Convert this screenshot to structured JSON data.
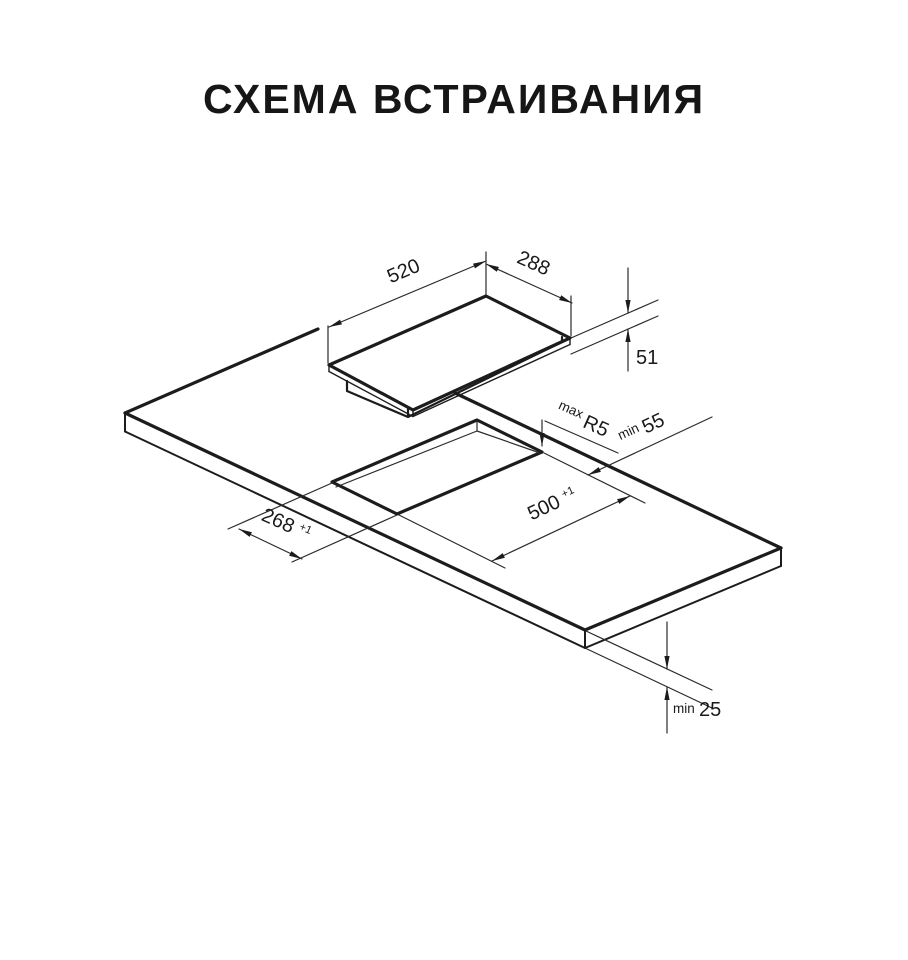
{
  "title": "СХЕМА ВСТРАИВАНИЯ",
  "colors": {
    "background": "#ffffff",
    "line": "#1c1c1c",
    "text": "#1a1a1a"
  },
  "dimensions": {
    "hob_width": {
      "value": "520"
    },
    "hob_depth": {
      "value": "288"
    },
    "hob_height": {
      "value": "51"
    },
    "cutout_corner_radius": {
      "prefix": "max",
      "value": "R5"
    },
    "cutout_back_clearance": {
      "prefix": "min",
      "value": "55"
    },
    "cutout_length": {
      "value": "500",
      "tolerance": "+1"
    },
    "cutout_width": {
      "value": "268",
      "tolerance": "+1"
    },
    "countertop_min_thickness": {
      "prefix": "min",
      "value": "25"
    }
  }
}
